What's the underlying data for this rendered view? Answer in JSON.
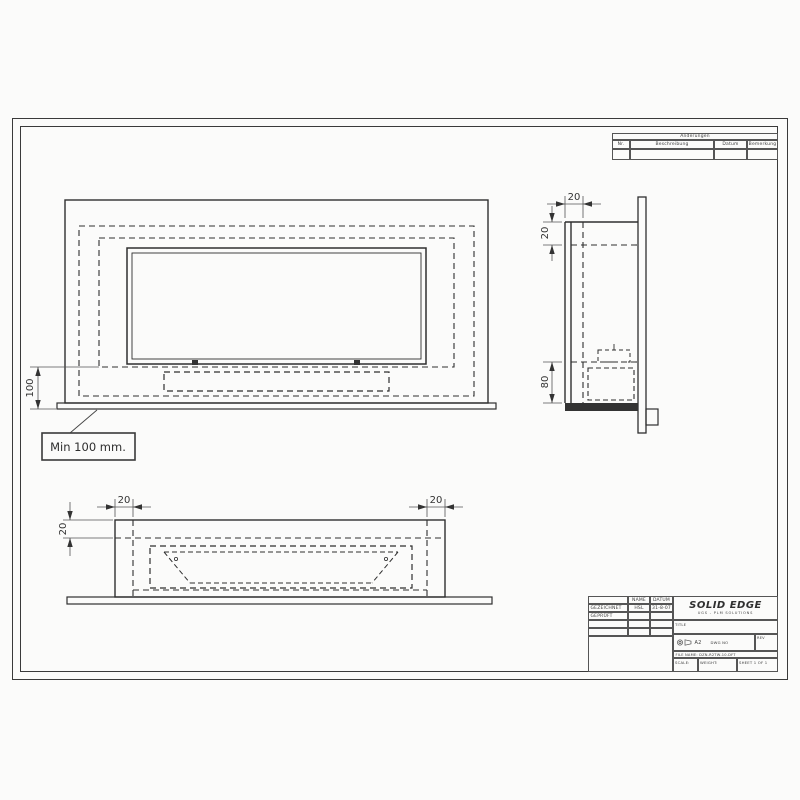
{
  "revision_table": {
    "title": "Änderungen",
    "columns": {
      "nr": "Nr.",
      "description": "Beschreibung",
      "date": "Datum",
      "note": "Bemerkung"
    }
  },
  "title_block": {
    "approvals": {
      "name_header": "NAME",
      "date_header": "DATUM",
      "row1": {
        "label": "GEZEICHNET",
        "name": "HSL",
        "date": "31-8-07"
      },
      "row2": {
        "label": "GEPRÜFT",
        "name": "",
        "date": ""
      }
    },
    "brand": {
      "name": "SOLID EDGE",
      "subtitle": "UGS - PLM SOLUTIONS"
    },
    "title_label": "TITLE",
    "size": "A2",
    "dwg_no_label": "DWG NO",
    "rev_label": "REV",
    "file_name": "FILE NAME: DZN-R2TW-10.DFT",
    "scale_label": "SCALE:",
    "weight_label": "WEIGHT:",
    "sheet_label": "SHEET 1 OF 1"
  },
  "callout": {
    "label": "Min 100 mm."
  },
  "dimensions": {
    "front_min_height": "100",
    "side_depth": "20",
    "side_top_wall": "20",
    "side_bottom_depth": "80",
    "bottom_left_wall": "20",
    "bottom_right_wall": "20",
    "bottom_front_wall": "20"
  },
  "colors": {
    "line": "#2f2f2f",
    "paper": "#fbfbfa"
  }
}
